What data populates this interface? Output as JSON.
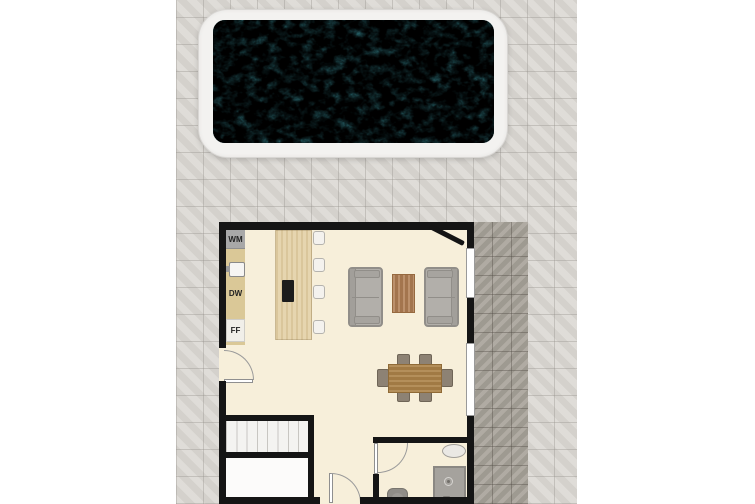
{
  "scene": {
    "description": "Top-view floor plan with swimming pool, open-plan kitchen/living room, stairs, store room and bathroom",
    "labels": {
      "wm": "WM",
      "dw": "DW",
      "ff": "FF"
    },
    "colors": {
      "pool_water": "#45adba",
      "pool_deck": "#f3f2f0",
      "paving_light": "#d9d6d1",
      "paving_dark": "#a7a299",
      "wall": "#151515",
      "floor": "#f7efda",
      "counter": "#dac897",
      "island_wood": "#e3d0a6",
      "cooktop": "#1c1c1c",
      "sofa": "#b2afaa",
      "coffee_table": "#b17f54",
      "dining_table": "#ab8248",
      "dining_chair": "#8d8274"
    }
  }
}
